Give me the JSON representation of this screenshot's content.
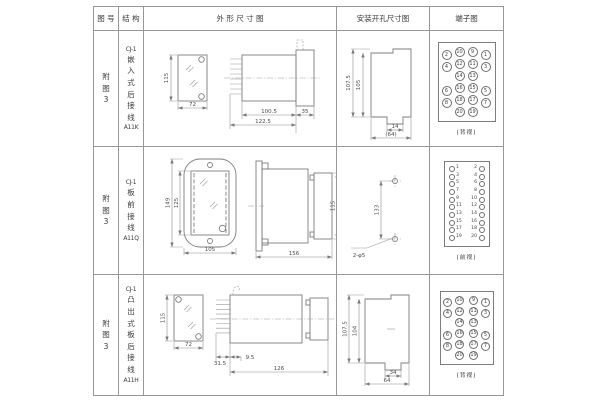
{
  "colors": {
    "ink": "#3a3a3a",
    "line": "#979797",
    "drawing": "#7d7d7d"
  },
  "table": {
    "headers": [
      "图 号",
      "结 构",
      "外  形  尺  寸  图",
      "安装开孔尺寸图",
      "端子图"
    ],
    "rows": [
      {
        "fig": "附图3",
        "structure": {
          "prefix": "CJ-1",
          "chars": "嵌入式后接线",
          "model": "A11K"
        },
        "outline": {
          "front_h": "115",
          "front_w": "72",
          "body_len": "100.5",
          "total_len": "122.5",
          "flange": "35"
        },
        "mounting": {
          "outer_h": "107.5",
          "inner_h": "105",
          "notch_w": "14",
          "total_w": "(64)"
        },
        "terminal": {
          "caption": "(背视)",
          "pins": [
            {
              "n": "2",
              "x": 8,
              "y": 12,
              "d": 10,
              "mode": "in"
            },
            {
              "n": "10",
              "x": 21,
              "y": 9,
              "d": 10,
              "mode": "in"
            },
            {
              "n": "9",
              "x": 34,
              "y": 9,
              "d": 10,
              "mode": "in"
            },
            {
              "n": "1",
              "x": 47,
              "y": 12,
              "d": 10,
              "mode": "in"
            },
            {
              "n": "4",
              "x": 8,
              "y": 24,
              "d": 10,
              "mode": "in"
            },
            {
              "n": "12",
              "x": 21,
              "y": 21,
              "d": 10,
              "mode": "in"
            },
            {
              "n": "11",
              "x": 34,
              "y": 21,
              "d": 10,
              "mode": "in"
            },
            {
              "n": "3",
              "x": 47,
              "y": 24,
              "d": 10,
              "mode": "in"
            },
            {
              "n": "14",
              "x": 21,
              "y": 33,
              "d": 10,
              "mode": "in"
            },
            {
              "n": "13",
              "x": 34,
              "y": 33,
              "d": 10,
              "mode": "in"
            },
            {
              "n": "6",
              "x": 8,
              "y": 48,
              "d": 10,
              "mode": "in"
            },
            {
              "n": "16",
              "x": 21,
              "y": 45,
              "d": 10,
              "mode": "in"
            },
            {
              "n": "15",
              "x": 34,
              "y": 45,
              "d": 10,
              "mode": "in"
            },
            {
              "n": "5",
              "x": 47,
              "y": 48,
              "d": 10,
              "mode": "in"
            },
            {
              "n": "8",
              "x": 8,
              "y": 60,
              "d": 10,
              "mode": "in"
            },
            {
              "n": "18",
              "x": 21,
              "y": 57,
              "d": 10,
              "mode": "in"
            },
            {
              "n": "17",
              "x": 34,
              "y": 57,
              "d": 10,
              "mode": "in"
            },
            {
              "n": "7",
              "x": 47,
              "y": 60,
              "d": 10,
              "mode": "in"
            },
            {
              "n": "20",
              "x": 21,
              "y": 69,
              "d": 10,
              "mode": "in"
            },
            {
              "n": "19",
              "x": 34,
              "y": 69,
              "d": 10,
              "mode": "in"
            }
          ]
        }
      },
      {
        "fig": "附图3",
        "structure": {
          "prefix": "CJ-1",
          "chars": "板前接线",
          "model": "A11Q"
        },
        "outline": {
          "outer_h": "149",
          "inner_h": "125",
          "width": "105",
          "length": "156",
          "side_h": "115"
        },
        "mounting": {
          "pitch": "133",
          "holes": "2-φ5"
        },
        "terminal": {
          "caption": "(前视)",
          "pins": [
            {
              "n": "1",
              "x": 7,
              "y": 7,
              "d": 6,
              "mode": "right"
            },
            {
              "n": "2",
              "x": 37,
              "y": 7,
              "d": 6,
              "mode": "left"
            },
            {
              "n": "3",
              "x": 7,
              "y": 15,
              "d": 6,
              "mode": "right"
            },
            {
              "n": "4",
              "x": 37,
              "y": 15,
              "d": 6,
              "mode": "left"
            },
            {
              "n": "5",
              "x": 7,
              "y": 22,
              "d": 6,
              "mode": "right"
            },
            {
              "n": "6",
              "x": 37,
              "y": 22,
              "d": 6,
              "mode": "left"
            },
            {
              "n": "7",
              "x": 7,
              "y": 30,
              "d": 6,
              "mode": "right"
            },
            {
              "n": "8",
              "x": 37,
              "y": 30,
              "d": 6,
              "mode": "left"
            },
            {
              "n": "9",
              "x": 7,
              "y": 38,
              "d": 6,
              "mode": "right"
            },
            {
              "n": "10",
              "x": 37,
              "y": 38,
              "d": 6,
              "mode": "left"
            },
            {
              "n": "11",
              "x": 7,
              "y": 45,
              "d": 6,
              "mode": "right"
            },
            {
              "n": "12",
              "x": 37,
              "y": 45,
              "d": 6,
              "mode": "left"
            },
            {
              "n": "13",
              "x": 7,
              "y": 53,
              "d": 6,
              "mode": "right"
            },
            {
              "n": "14",
              "x": 37,
              "y": 53,
              "d": 6,
              "mode": "left"
            },
            {
              "n": "15",
              "x": 7,
              "y": 61,
              "d": 6,
              "mode": "right"
            },
            {
              "n": "16",
              "x": 37,
              "y": 61,
              "d": 6,
              "mode": "left"
            },
            {
              "n": "17",
              "x": 7,
              "y": 68,
              "d": 6,
              "mode": "right"
            },
            {
              "n": "18",
              "x": 37,
              "y": 68,
              "d": 6,
              "mode": "left"
            },
            {
              "n": "19",
              "x": 7,
              "y": 76,
              "d": 6,
              "mode": "right"
            },
            {
              "n": "20",
              "x": 37,
              "y": 76,
              "d": 6,
              "mode": "left"
            }
          ]
        }
      },
      {
        "fig": "附图3",
        "structure": {
          "prefix": "CJ-1",
          "chars": "凸出式板后接线",
          "model": "A11H"
        },
        "outline": {
          "front_h": "115",
          "front_w": "72",
          "pin_len": "31.5",
          "offset": "9.5",
          "length": "126"
        },
        "mounting": {
          "outer_h": "107.5",
          "inner_h": "104",
          "notch_w": "34",
          "total_w": "64"
        },
        "terminal": {
          "caption": "(背视)",
          "pins": [
            {
              "n": "2",
              "x": 7,
              "y": 10,
              "d": 9,
              "mode": "in"
            },
            {
              "n": "10",
              "x": 19,
              "y": 8,
              "d": 9,
              "mode": "in"
            },
            {
              "n": "9",
              "x": 33,
              "y": 8,
              "d": 9,
              "mode": "in"
            },
            {
              "n": "1",
              "x": 45,
              "y": 10,
              "d": 9,
              "mode": "in"
            },
            {
              "n": "4",
              "x": 7,
              "y": 21,
              "d": 9,
              "mode": "in"
            },
            {
              "n": "12",
              "x": 19,
              "y": 19,
              "d": 9,
              "mode": "in"
            },
            {
              "n": "11",
              "x": 33,
              "y": 19,
              "d": 9,
              "mode": "in"
            },
            {
              "n": "3",
              "x": 45,
              "y": 21,
              "d": 9,
              "mode": "in"
            },
            {
              "n": "14",
              "x": 19,
              "y": 30,
              "d": 9,
              "mode": "in"
            },
            {
              "n": "13",
              "x": 33,
              "y": 30,
              "d": 9,
              "mode": "in"
            },
            {
              "n": "6",
              "x": 7,
              "y": 43,
              "d": 9,
              "mode": "in"
            },
            {
              "n": "16",
              "x": 19,
              "y": 41,
              "d": 9,
              "mode": "in"
            },
            {
              "n": "15",
              "x": 33,
              "y": 41,
              "d": 9,
              "mode": "in"
            },
            {
              "n": "5",
              "x": 45,
              "y": 43,
              "d": 9,
              "mode": "in"
            },
            {
              "n": "8",
              "x": 7,
              "y": 54,
              "d": 9,
              "mode": "in"
            },
            {
              "n": "18",
              "x": 19,
              "y": 52,
              "d": 9,
              "mode": "in"
            },
            {
              "n": "17",
              "x": 33,
              "y": 52,
              "d": 9,
              "mode": "in"
            },
            {
              "n": "7",
              "x": 45,
              "y": 54,
              "d": 9,
              "mode": "in"
            },
            {
              "n": "20",
              "x": 19,
              "y": 63,
              "d": 9,
              "mode": "in"
            },
            {
              "n": "19",
              "x": 33,
              "y": 63,
              "d": 9,
              "mode": "in"
            }
          ]
        }
      }
    ]
  }
}
